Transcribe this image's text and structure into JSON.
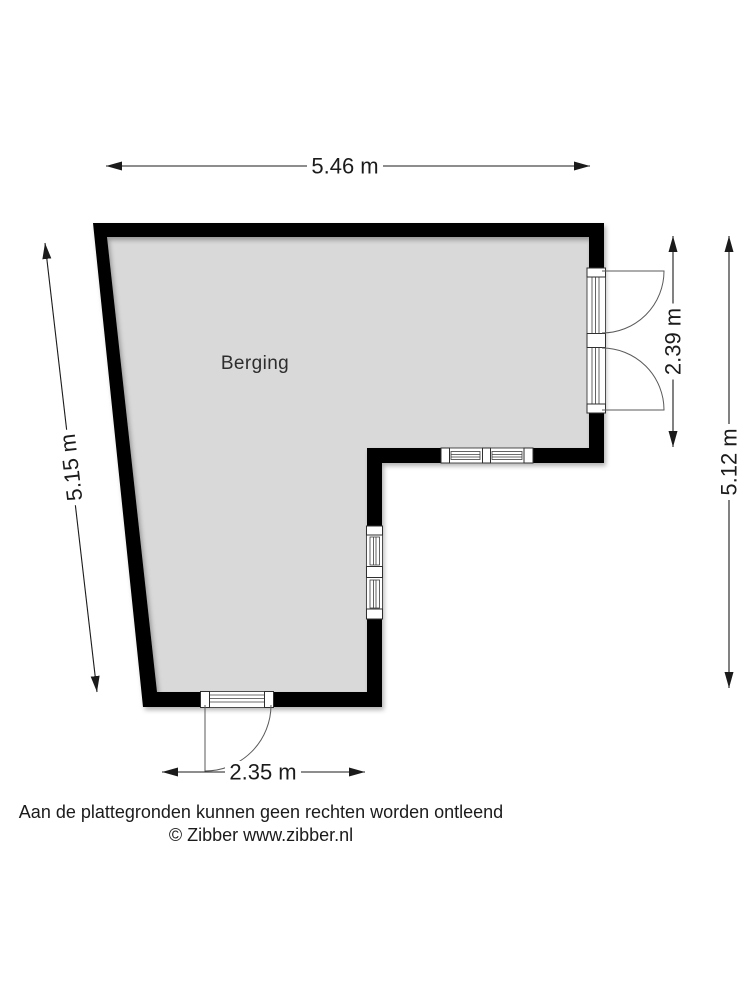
{
  "floorplan": {
    "room_label": "Berging",
    "dimensions": {
      "top": "5.46 m",
      "left": "5.15 m",
      "door_right": "2.39 m",
      "right": "5.12 m",
      "bottom": "2.35 m"
    },
    "colors": {
      "wall": "#000000",
      "floor": "#d9d9d9",
      "dimension": "#1b1b1b"
    }
  },
  "footer": {
    "disclaimer": "Aan de plattegronden kunnen geen rechten worden ontleend",
    "copyright": "© Zibber www.zibber.nl"
  }
}
